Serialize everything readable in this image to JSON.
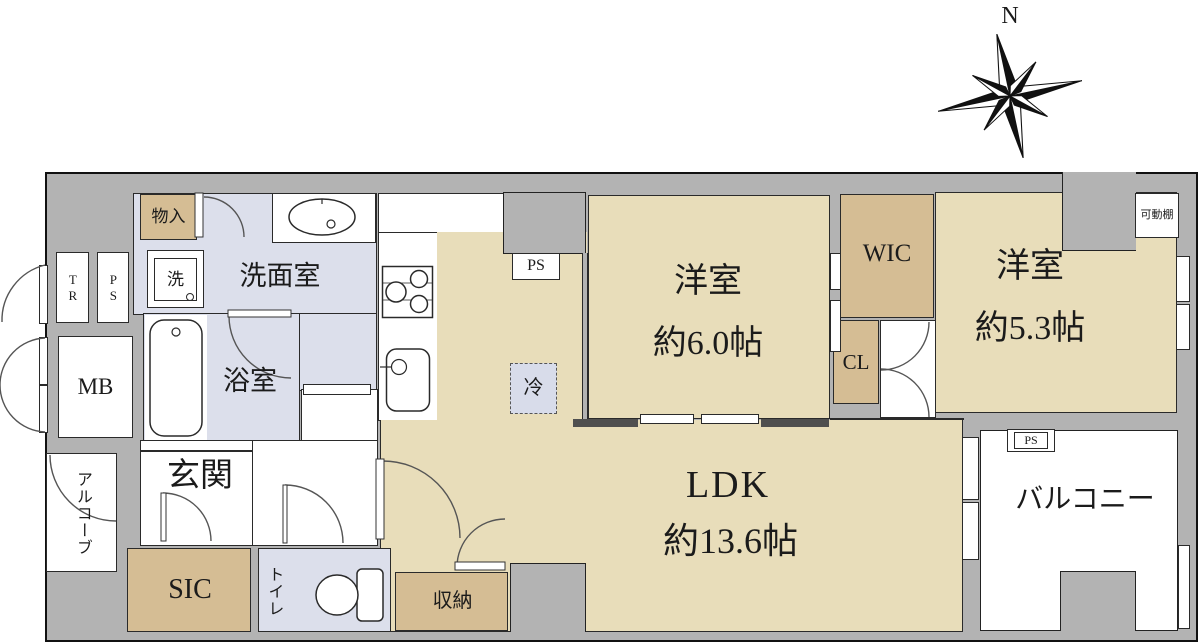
{
  "compass": {
    "north": "N"
  },
  "labels": {
    "monoire": "物入",
    "tr": "TR",
    "ps": "PS",
    "mb": "MB",
    "washer": "洗",
    "washroom": "洗面室",
    "bathroom": "浴室",
    "entrance": "玄関",
    "alcove": "アルコーブ",
    "sic": "SIC",
    "toilet": "トイレ",
    "storage": "収納",
    "refrigerator": "冷",
    "bedroom1_name": "洋室",
    "bedroom1_size": "約6.0帖",
    "wic": "WIC",
    "cl": "CL",
    "bedroom2_name": "洋室",
    "bedroom2_size": "約5.3帖",
    "movable_shelf": "可動棚",
    "ldk_name": "LDK",
    "ldk_size": "約13.6帖",
    "balcony": "バルコニー",
    "ps_kitchen": "PS",
    "ps_balcony": "PS"
  },
  "colors": {
    "wall": "#b3b3b3",
    "floor_tan": "#e8ddba",
    "storage_tan": "#d5bd94",
    "wet_area_blue": "#dcdfeb",
    "outline": "#111111"
  }
}
